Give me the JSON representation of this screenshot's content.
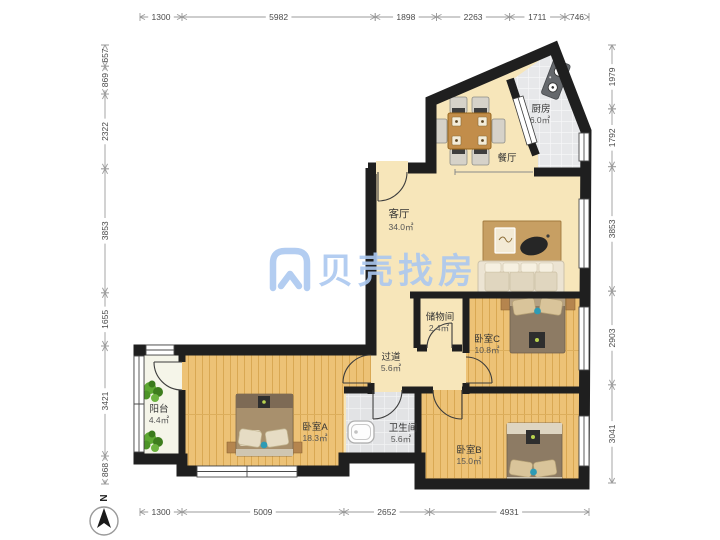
{
  "plan_title": "三室一厅户型图",
  "watermark": {
    "logo": "beike-shell-logo",
    "text": "贝壳找房",
    "color": "#abc8f0"
  },
  "compass": {
    "label": "N"
  },
  "rooms": {
    "living": {
      "name": "客厅",
      "area": "34.0㎡"
    },
    "dining": {
      "name": "餐厅"
    },
    "kitchen": {
      "name": "厨房",
      "area": "6.0㎡"
    },
    "storage": {
      "name": "储物间",
      "area": "2.4㎡"
    },
    "hallway": {
      "name": "过道",
      "area": "5.6㎡"
    },
    "bedroom_a": {
      "name": "卧室A",
      "area": "18.3㎡"
    },
    "bedroom_b": {
      "name": "卧室B",
      "area": "15.0㎡"
    },
    "bedroom_c": {
      "name": "卧室C",
      "area": "10.8㎡"
    },
    "bathroom": {
      "name": "卫生间",
      "area": "5.6㎡"
    },
    "balcony": {
      "name": "阳台",
      "area": "4.4㎡"
    }
  },
  "dimensions_mm": {
    "top": [
      "1300",
      "5982",
      "1898",
      "2263",
      "1711",
      "746"
    ],
    "bottom": [
      "1300",
      "5009",
      "2652",
      "4931"
    ],
    "left": [
      "657",
      "869",
      "2322",
      "3853",
      "1655",
      "3421",
      "868"
    ],
    "right": [
      "1979",
      "1792",
      "3853",
      "2903",
      "3041"
    ]
  },
  "colors": {
    "wall": "#1f1f1f",
    "floor_beige": "#f7e6ba",
    "floor_wood": "#edc276",
    "tile": "#e7e8ea",
    "accent_teal": "#2e9bb5",
    "watermark_blue": "#abc8f0",
    "dimension_line": "#9b9b9b"
  }
}
